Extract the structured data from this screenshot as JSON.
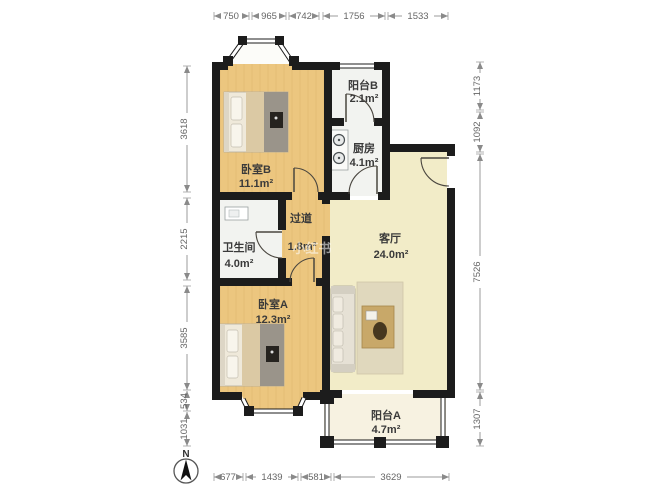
{
  "compass": {
    "label": "N"
  },
  "watermark": "小红书",
  "rooms": {
    "bedroom_b": {
      "name": "卧室B",
      "area": "11.1m²"
    },
    "balcony_b": {
      "name": "阳台B",
      "area": "2.1m²"
    },
    "kitchen": {
      "name": "厨房",
      "area": "4.1m²"
    },
    "bathroom": {
      "name": "卫生间",
      "area": "4.0m²"
    },
    "hallway": {
      "name": "过道",
      "area": "1.8m²"
    },
    "living_room": {
      "name": "客厅",
      "area": "24.0m²"
    },
    "bedroom_a": {
      "name": "卧室A",
      "area": "12.3m²"
    },
    "balcony_a": {
      "name": "阳台A",
      "area": "4.7m²"
    }
  },
  "dimensions_mm": {
    "top": [
      "750",
      "965",
      "742",
      "1756",
      "1533"
    ],
    "left": [
      "3618",
      "2215",
      "3585",
      "534",
      "1031"
    ],
    "right": [
      "1173",
      "1092",
      "7526",
      "1307"
    ],
    "bottom": [
      "677",
      "1439",
      "581",
      "3629"
    ]
  },
  "colors": {
    "wall": "#1c1c1c",
    "wood_floor": "#ecc67f",
    "living_floor": "#f2ecc8",
    "tile_floor": "#f2f3f0",
    "balcony_floor": "#f7f2e1",
    "dimension_line": "#999999"
  }
}
